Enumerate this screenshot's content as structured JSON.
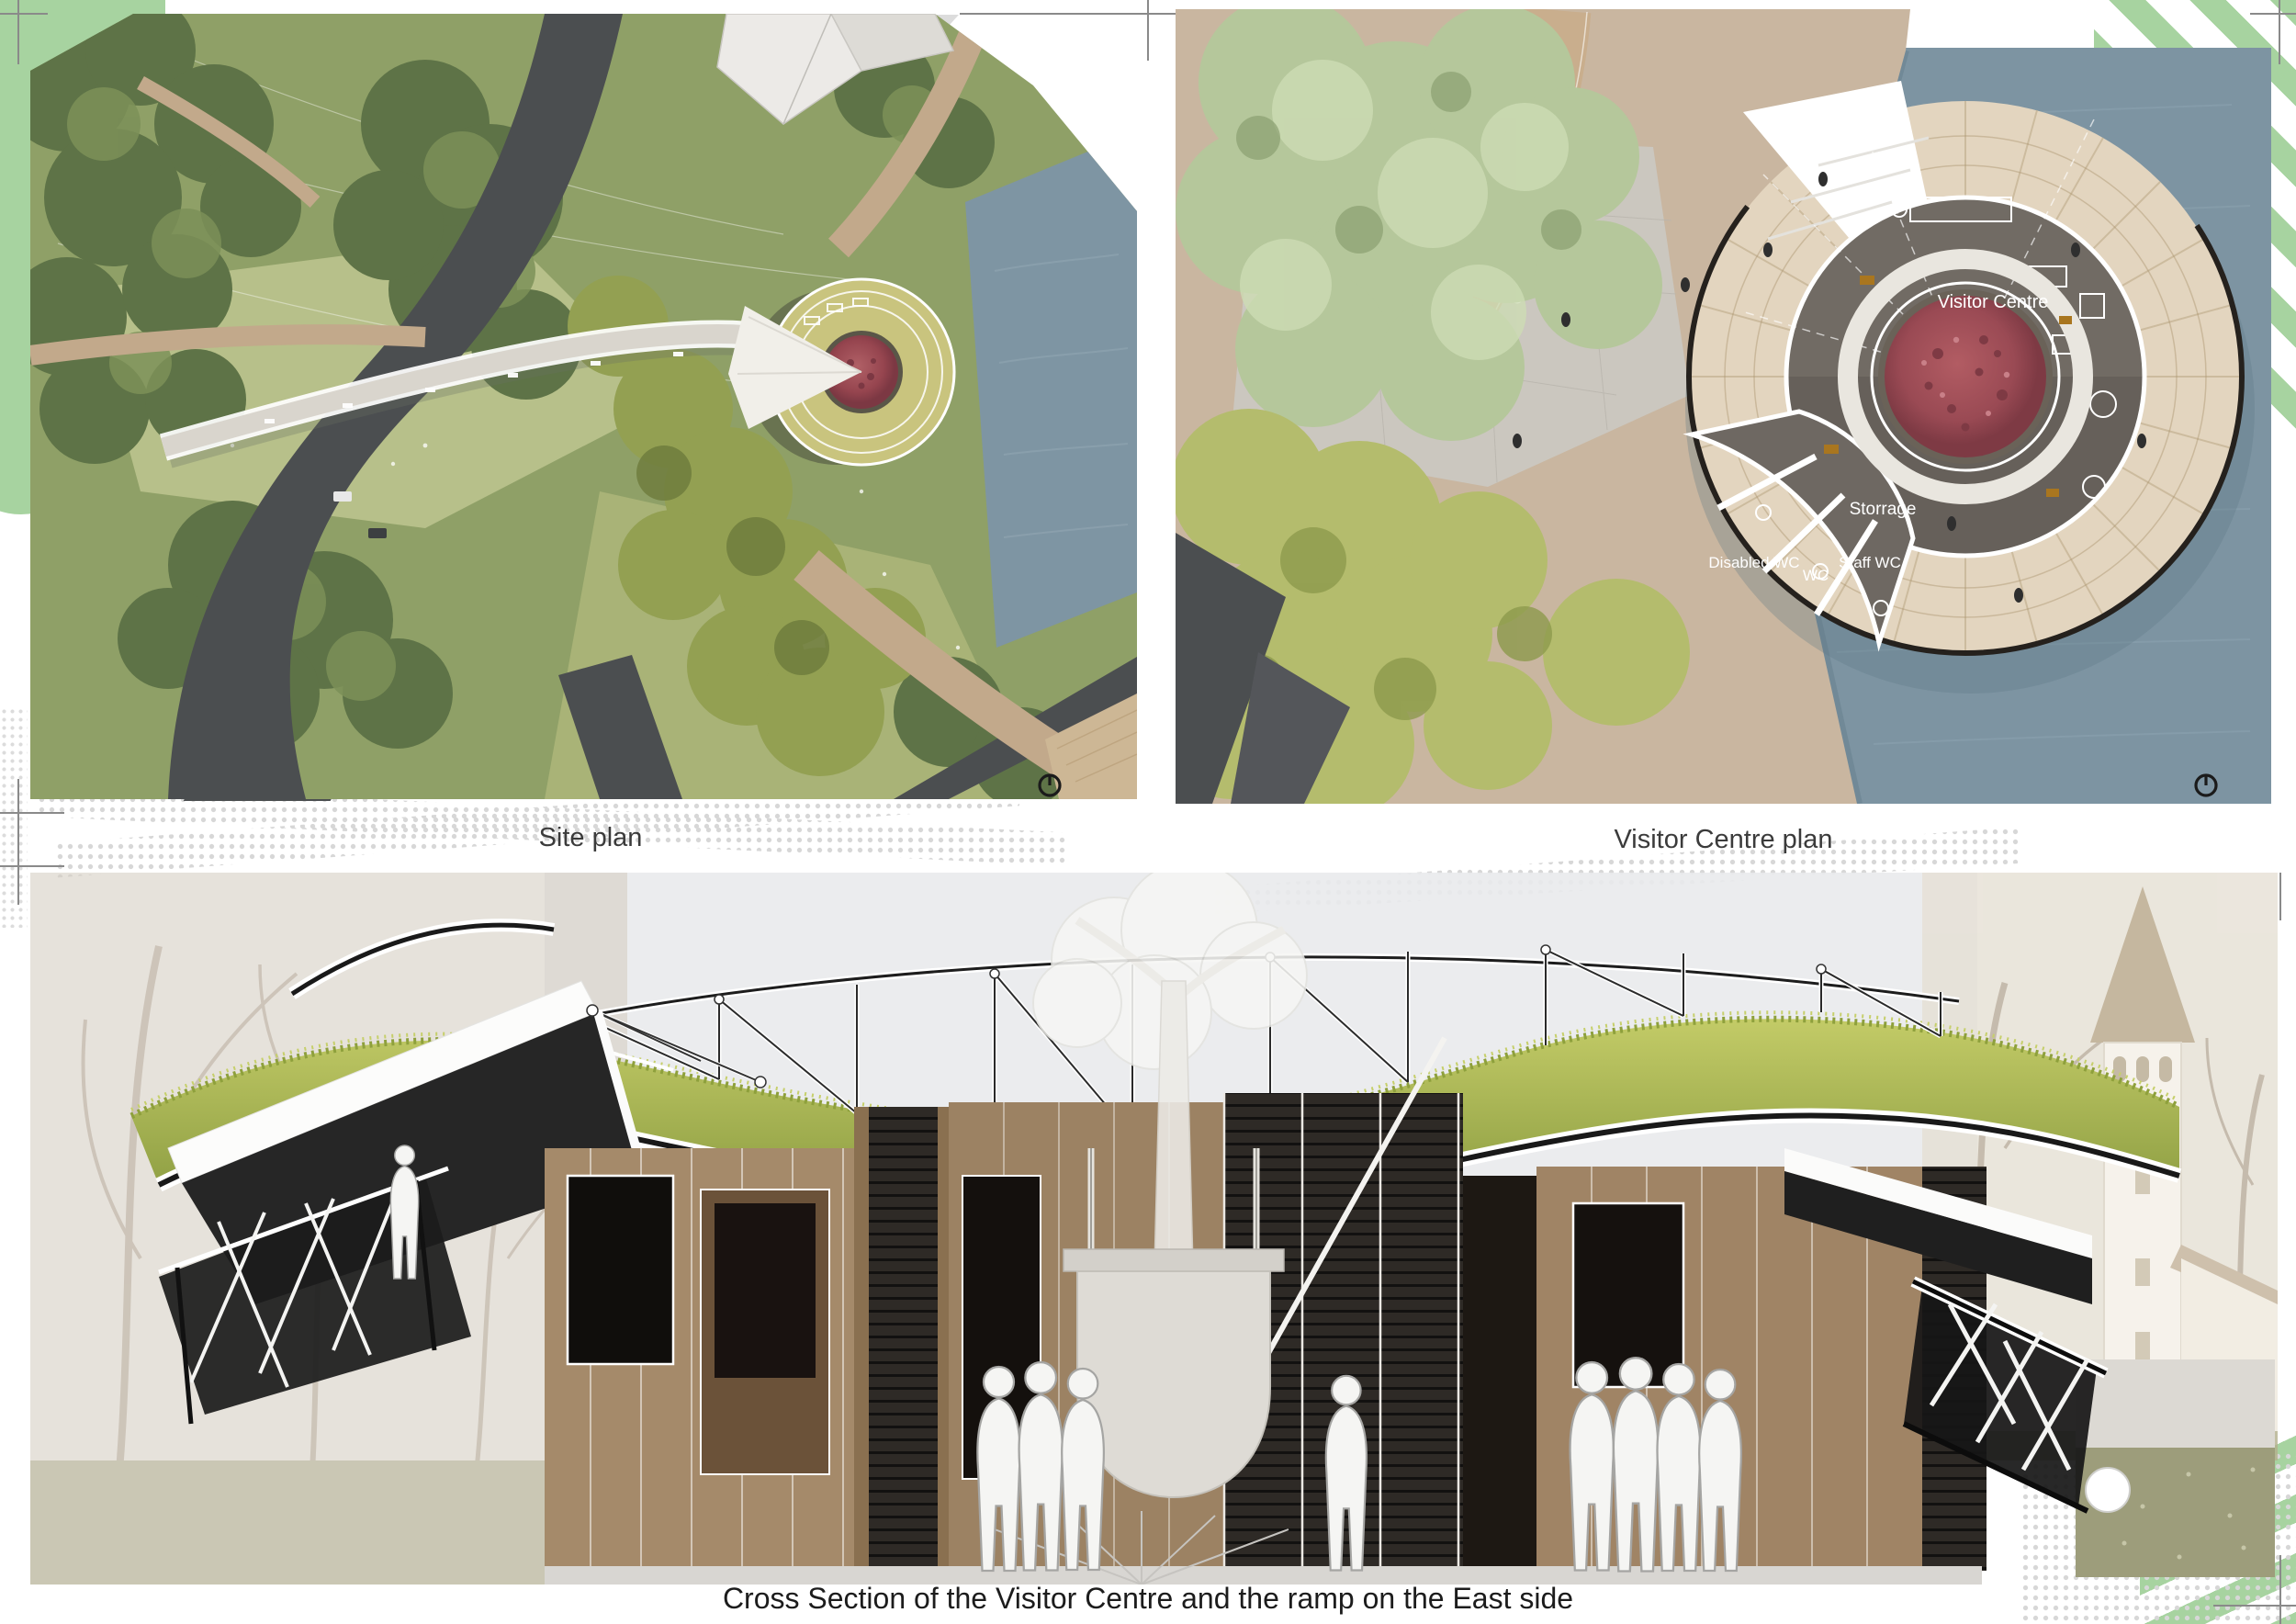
{
  "board": {
    "background": "#ffffff",
    "accent_green": "#a7d3a0",
    "halftone_gray": "#d8d8d8",
    "regmark_gray": "#8a8a8a"
  },
  "site_plan": {
    "caption": "Site plan",
    "icons": {
      "north": "north-indicator-icon"
    },
    "colors": {
      "meadow": "#8fa067",
      "woodland": "#5e7347",
      "water": "#7e95a3",
      "road": "#4b4e50",
      "path": "#c2a98b",
      "bridge": "#d9d5cd",
      "viewpoint_roof": "#c9c47e",
      "feature_tree": "#9c4f58"
    }
  },
  "visitor_centre_plan": {
    "caption": "Visitor Centre plan",
    "rooms": {
      "main_hall": "Visitor Centre",
      "storage": "Storrage",
      "disabled_wc": "Disabled WC",
      "wc": "WC",
      "staff_wc": "Staff WC"
    },
    "icons": {
      "north": "north-indicator-icon"
    },
    "colors": {
      "deck": "#e3d5bf",
      "floor": "#716b64",
      "water": "#7d94a2",
      "canopy": "#b5c79b",
      "feature_tree": "#a25059",
      "plaza": "#cbc7bf"
    }
  },
  "cross_section": {
    "caption": "Cross Section of the Visitor Centre and the ramp on the East side",
    "colors": {
      "grass_roof": "#a9b84f",
      "timber_wall": "#a58a6a",
      "charred_wall": "#2a2522",
      "silhouette": "#f5f5f3",
      "sky": "#e9eaec"
    }
  }
}
